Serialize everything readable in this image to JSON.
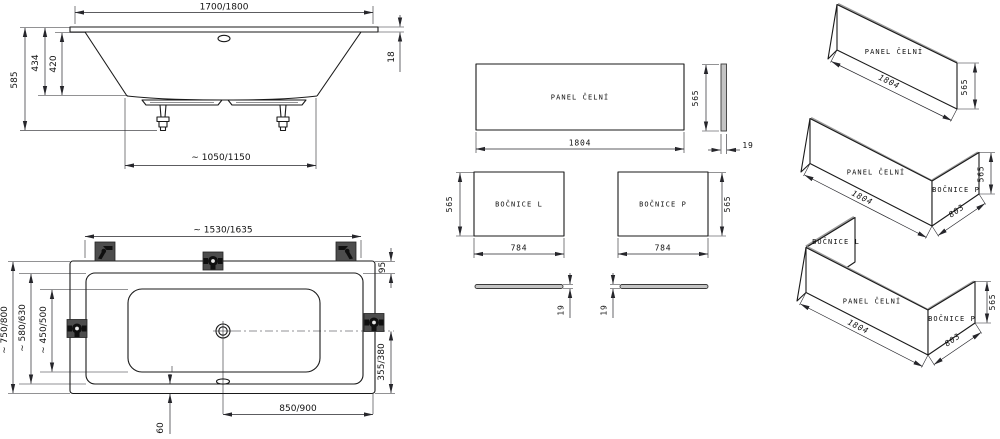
{
  "colors": {
    "line": "#1a1a1a",
    "dim_line": "#26262b",
    "text": "#111111",
    "bracket_fill": "#4d4d4d",
    "bracket_glyph": "#101010",
    "bar_fill": "#c4c4c4",
    "edge_shade": "#9a9a9a",
    "background": "#ffffff"
  },
  "elevation_view": {
    "length": "1700/1800",
    "total_height": "585",
    "shell_height": "434",
    "inner_depth": "420",
    "rim_thickness": "18",
    "base_length": "∼ 1050/1150"
  },
  "plan_view": {
    "mount_span": "∼ 1530/1635",
    "outer_width": "∼ 750/800",
    "rim_width": "∼ 580/630",
    "inner_width": "∼ 450/500",
    "rim_offset": "95",
    "drain_to_side": "355/380",
    "drain_to_end": "850/900",
    "overflow_offset": "60"
  },
  "panel_views": {
    "front_panel": {
      "label": "PANEL ČELNÍ",
      "width": "1804",
      "height": "565",
      "thickness": "19"
    },
    "side_panel_left": {
      "label": "BOČNICE L",
      "width": "784",
      "height": "565",
      "thickness": "19"
    },
    "side_panel_right": {
      "label": "BOČNICE P",
      "width": "784",
      "height": "565",
      "thickness": "19"
    }
  },
  "assembly_views": {
    "front_only": {
      "front_label": "PANEL ČELNÍ",
      "width": "1804",
      "height": "565"
    },
    "front_with_right": {
      "front_label": "PANEL ČELNÍ",
      "right_label": "BOČNICE P",
      "width": "1804",
      "depth": "803",
      "height": "565"
    },
    "full_set": {
      "left_label": "BOČNICE L",
      "front_label": "PANEL ČELNÍ",
      "right_label": "BOČNICE P",
      "width": "1804",
      "depth": "803",
      "height": "565"
    }
  }
}
